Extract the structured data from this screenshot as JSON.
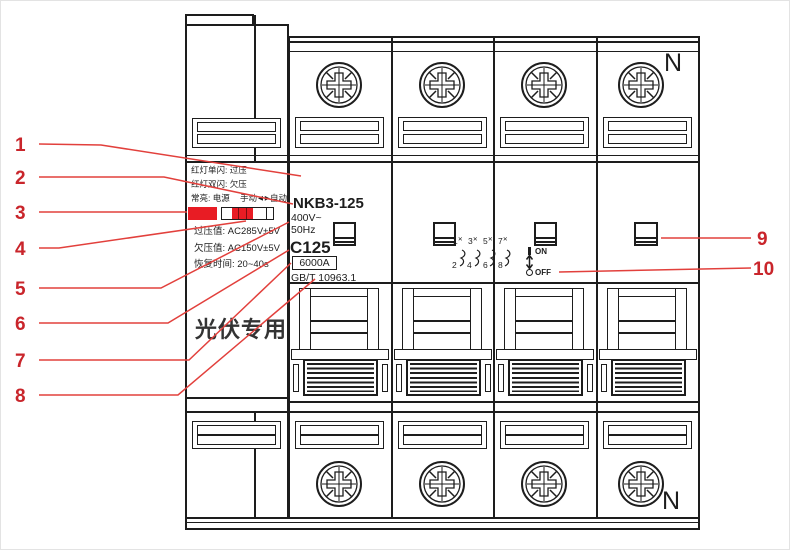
{
  "callouts": {
    "left": [
      "1",
      "2",
      "3",
      "4",
      "5",
      "6",
      "7",
      "8"
    ],
    "right": [
      "9",
      "10"
    ]
  },
  "protection_module": {
    "legend1": "红灯单闪: 过压",
    "legend2": "红灯双闪: 欠压",
    "status": "常亮: 电源",
    "manual": "手动",
    "arrows": "◀ ▶",
    "auto": "自动",
    "overvoltage": "过压值: AC285V±5V",
    "undervoltage": "欠压值: AC150V±5V",
    "recovery": "恢复时间: 20~40s",
    "pv": "光伏专用"
  },
  "breaker": {
    "model": "NKB3-125",
    "voltage": "400V~",
    "freq": "50Hz",
    "curve": "C125",
    "capacity": "6000A",
    "standard": "GB/T 10963.1",
    "n_top": "N",
    "n_bottom": "N",
    "on": "ON",
    "off": "OFF",
    "wiring": {
      "top": [
        "1",
        "3",
        "5",
        "7"
      ],
      "bottom": [
        "2",
        "4",
        "6",
        "8"
      ],
      "x": "✕"
    }
  },
  "colors": {
    "callout_red": "#c9252b",
    "leader_red": "#e2403c",
    "led_red": "#e81c24",
    "line_dark": "#1d1d1d"
  }
}
